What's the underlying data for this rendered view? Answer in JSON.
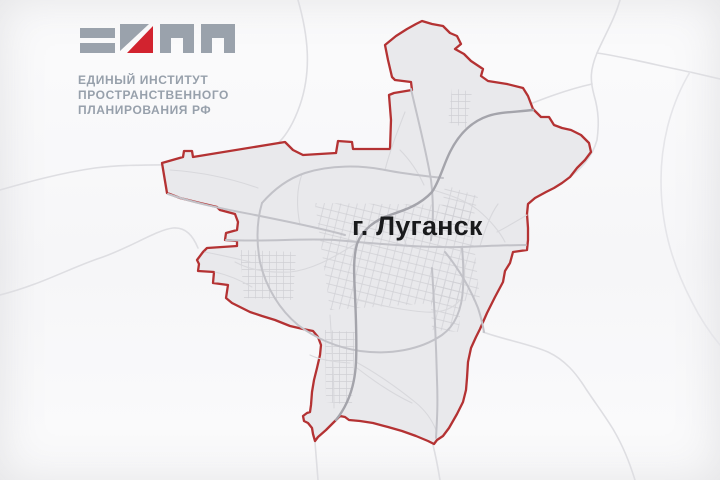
{
  "logo": {
    "name": "ЕИПП",
    "lines": [
      "ЕДИНЫЙ ИНСТИТУТ",
      "ПРОСТРАНСТВЕННОГО",
      "ПЛАНИРОВАНИЯ РФ"
    ],
    "mark_gray": "#9aa2ac",
    "mark_red": "#d2232f",
    "text_color": "#97a0ab"
  },
  "map": {
    "city_label": "г. Луганск",
    "boundary_color": "#b43233",
    "city_fill": "#e9e9ec",
    "background": "#f8f8fa",
    "road_color_dark": "#a4a4ab",
    "road_color_medium": "#c2c2c8",
    "road_color_minor": "#d8d8dc",
    "road_color_exterior": "#dedee2",
    "label_color": "#191a1c"
  }
}
